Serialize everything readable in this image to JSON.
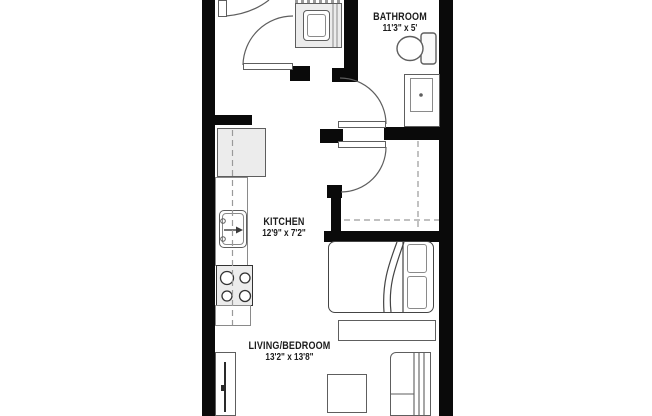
{
  "title": "Studio apartment floor plan",
  "rooms": [
    {
      "name": "BATHROOM",
      "dimensions": "11'3\" x 5'"
    },
    {
      "name": "KITCHEN",
      "dimensions": "12'9\" x 7'2\""
    },
    {
      "name": "LIVING/BEDROOM",
      "dimensions": "13'2\" x 13'8\""
    }
  ],
  "fixtures": [
    "washer-dryer",
    "entry-door",
    "toilet",
    "vanity-sink",
    "bathroom-door",
    "closet-door",
    "closet-dashed-rod",
    "refrigerator",
    "kitchen-counter",
    "kitchen-sink",
    "stove",
    "bed",
    "pillows",
    "bench",
    "coffee-table",
    "sofa",
    "tv-console"
  ],
  "colors": {
    "wall": "#0a0a0a",
    "background": "#ffffff",
    "fixture_outline": "#5e5e5e",
    "fixture_fill": "#ececec",
    "dashed_line": "#9a9a9a",
    "label_text": "#1c1c1c"
  }
}
